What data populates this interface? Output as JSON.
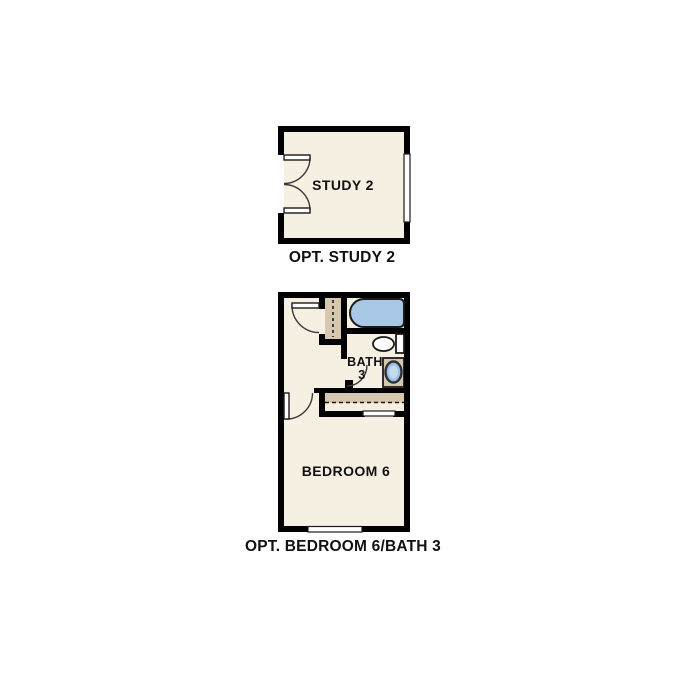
{
  "colors": {
    "background": "#ffffff",
    "wall": "#000000",
    "floor": "#f6f0e3",
    "closet": "#d6c8ae",
    "tub": "#a9c8e6",
    "basin": "#9cc0e2",
    "basin_highlight": "#c6daee",
    "text": "#111111"
  },
  "study_plan": {
    "room_label": "STUDY 2",
    "caption": "OPT. STUDY 2",
    "fixtures": [
      "double-french-doors",
      "window"
    ]
  },
  "bedroom_bath_plan": {
    "bath_label": "BATH",
    "bath_number": "3",
    "bedroom_label": "BEDROOM 6",
    "caption": "OPT. BEDROOM 6/BATH 3",
    "fixtures": [
      "bathtub",
      "toilet",
      "sink-vanity",
      "linen-closet",
      "bedroom-closet",
      "hinged-doors",
      "window"
    ]
  }
}
